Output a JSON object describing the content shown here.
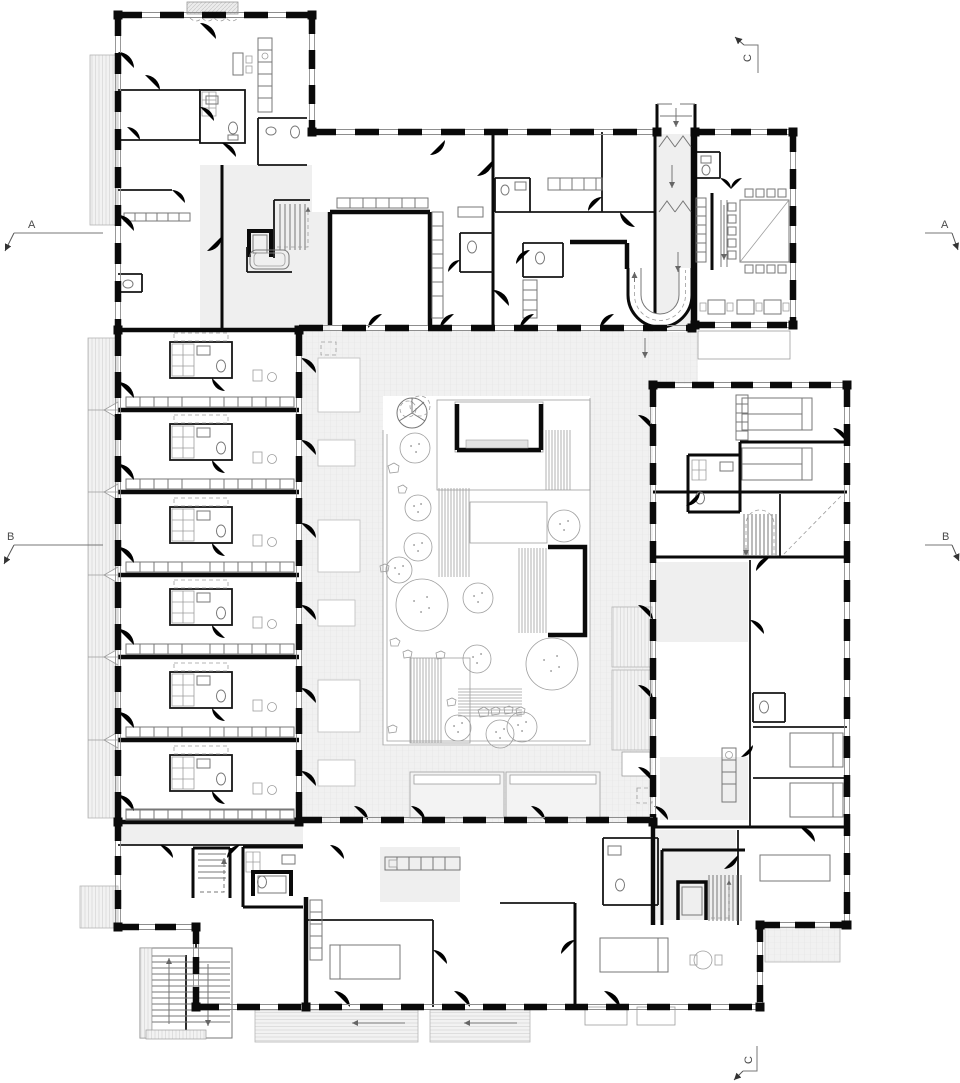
{
  "drawing": {
    "kind": "architectural-floor-plan",
    "description": "Ground floor plan of a courtyard building with four wings, central garden, repeated resident rooms, dining hall, ramps and stairs",
    "background": "#ffffff"
  },
  "colors": {
    "wall": "#0a0a0a",
    "detail_line": "#777777",
    "light_line": "#9d9d9d",
    "walkway_fill": "#f0f0f0",
    "terrace_hatch": "#d9d9d9",
    "marker_text": "#4a4a4a"
  },
  "section_markers": {
    "a_left": "A",
    "a_right": "A",
    "b_left": "B",
    "b_right": "B",
    "c_top": "C",
    "c_bottom": "C"
  },
  "legend": {
    "wings": [
      "north-west-wing",
      "north-wing",
      "dining-pavilion",
      "west-room-wing",
      "east-wing",
      "south-wing"
    ],
    "courtyard": {
      "trees": 12,
      "deck-strips": 5,
      "garden-pavilions": 2,
      "compass-rose": 1
    },
    "stairs": [
      "nw-core-stair",
      "entry-ramp",
      "dining-ramp",
      "east-core-stair",
      "south-core-stair",
      "sw-exterior-stair",
      "sw-winder-stair"
    ],
    "elevators": [
      "nw-lift",
      "south-lift",
      "sw-lift"
    ]
  }
}
